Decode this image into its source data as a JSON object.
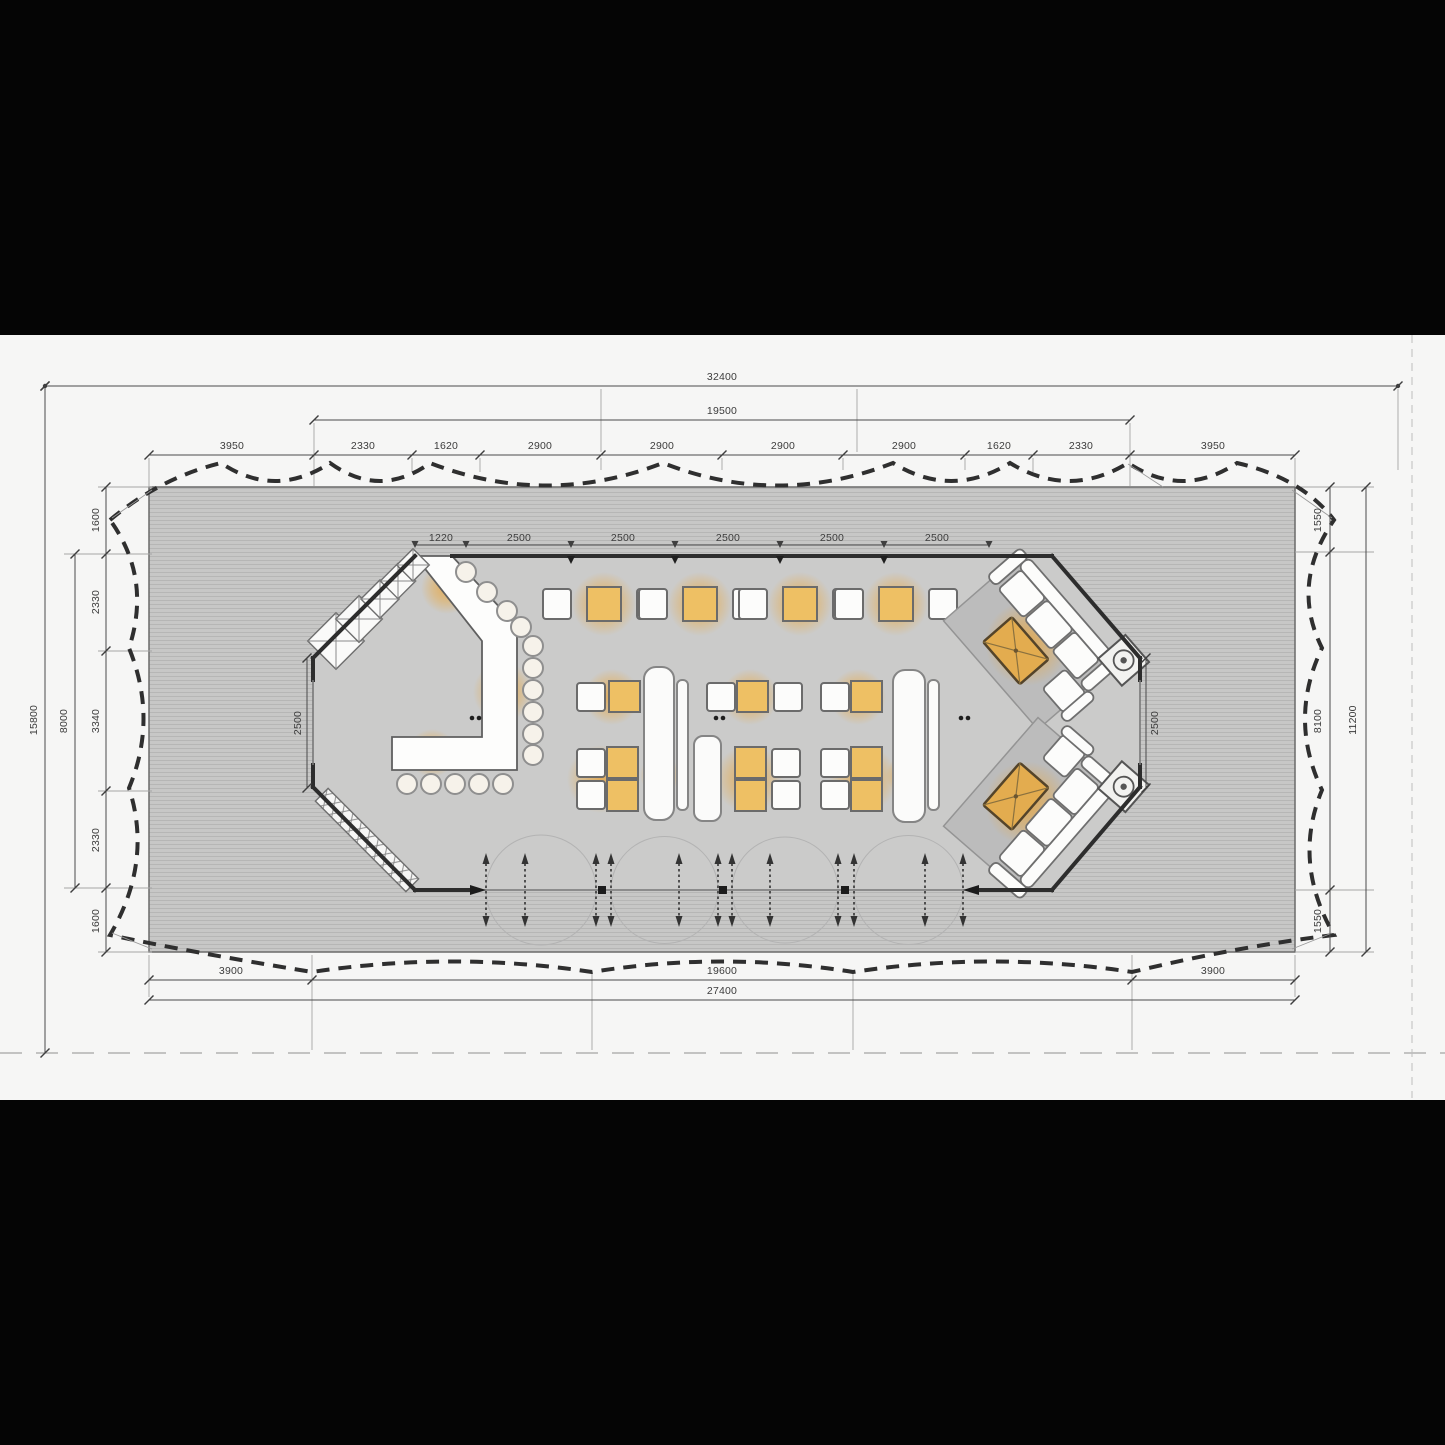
{
  "drawing": {
    "kind": "restaurant-pavilion-floor-plan",
    "units": "mm"
  },
  "dims": {
    "top_overall": "32400",
    "top_inner": "19500",
    "top_segments": [
      "3950",
      "2330",
      "1620",
      "2900",
      "2900",
      "2900",
      "2900",
      "1620",
      "2330",
      "3950"
    ],
    "building_top_segments": [
      "1220",
      "2500",
      "2500",
      "2500",
      "2500",
      "2500"
    ],
    "building_left_wall": "2500",
    "building_right_wall": "2500",
    "left_overall": "15800",
    "left_mid": "8000",
    "left_segments": [
      "1600",
      "2330",
      "3340",
      "2330",
      "1600"
    ],
    "right_segments": [
      "1550",
      "8100",
      "1550"
    ],
    "right_overall": "11200",
    "bottom_segments": [
      "3900",
      "19600",
      "3900"
    ],
    "bottom_overall": "27400"
  },
  "colors": {
    "letterbox": "#050505",
    "paper": "#f6f6f5",
    "deck": "#c7c7c6",
    "deck_stripe": "#b6b6b5",
    "interior": "#cbcbca",
    "wall": "#2d2d2d",
    "tent_dash": "#2f2f2f",
    "dimension": "#3f3f3f",
    "furniture_white": "#fcfcfb",
    "table_orange": "#eec064",
    "glow_orange": "#e8a33a",
    "rug_gray": "#bcbcbc"
  },
  "elements": [
    "deck-platform",
    "tent-canopy-outline",
    "pavilion-building",
    "bar-counter",
    "bar-stools",
    "back-counter-cabinets",
    "dining-tables",
    "banquette-benches",
    "lounge-sofa-groups",
    "folding-door-row",
    "dimension-lines"
  ]
}
